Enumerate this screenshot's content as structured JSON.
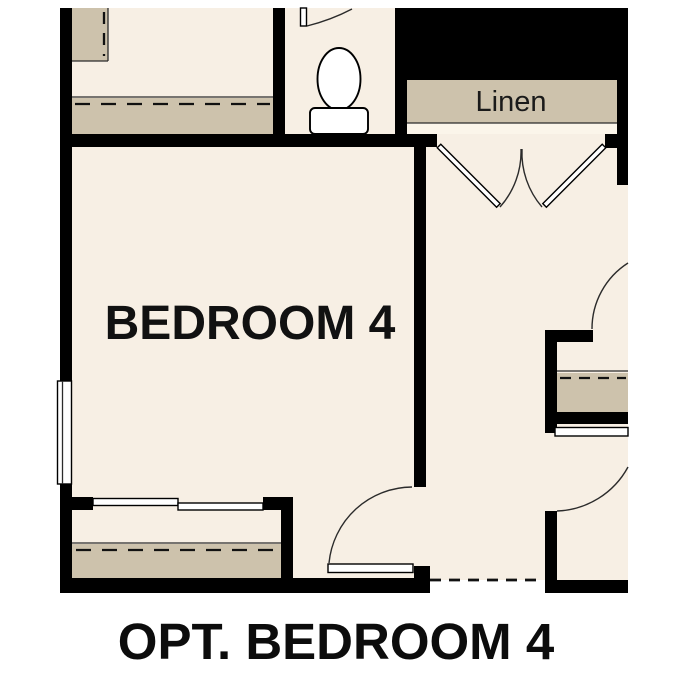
{
  "plan": {
    "room_label": "BEDROOM 4",
    "closet_label": "Linen",
    "caption": "OPT. BEDROOM 4",
    "colors": {
      "wall": "#000000",
      "floor": "#f7efe4",
      "linen_floor": "#fbf5ea",
      "shelf": "#cdc2ac",
      "background": "#ffffff",
      "fixture": "#ffffff",
      "line": "#2b2b2b",
      "text": "#111111"
    },
    "features": [
      "bedroom-4",
      "linen-closet-double-doors",
      "toilet-room",
      "bedroom-closet-sliding-doors",
      "window",
      "hall-doors"
    ]
  }
}
